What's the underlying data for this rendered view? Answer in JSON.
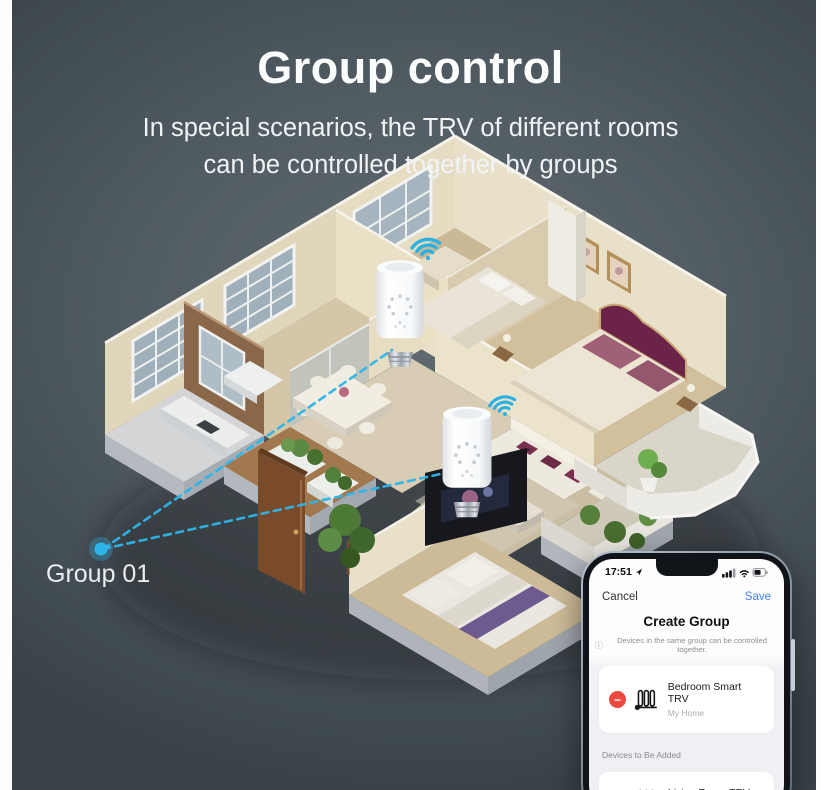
{
  "header": {
    "title": "Group control",
    "subtitle_line1": "In special scenarios, the TRV of different rooms",
    "subtitle_line2": "can be controlled together by groups"
  },
  "scene": {
    "group_label": "Group 01",
    "accent_color": "#2db5ea",
    "device_count": 2
  },
  "phone": {
    "status": {
      "time": "17:51"
    },
    "nav": {
      "cancel_label": "Cancel",
      "save_label": "Save"
    },
    "screen_title": "Create Group",
    "info_icon": "ⓘ",
    "info_note": "Devices in the same group can be controlled together.",
    "group_devices": [
      {
        "name": "Bedroom Smart TRV",
        "location": "My Home",
        "action_glyph": "−"
      }
    ],
    "section_label": "Devices to Be Added",
    "addable_devices": [
      {
        "name": "Living Room TRV",
        "location": "My Home",
        "action_glyph": "+"
      }
    ],
    "colors": {
      "save_blue": "#4683f5",
      "remove_red": "#ec4a3f",
      "add_green": "#2ebd4e"
    }
  }
}
